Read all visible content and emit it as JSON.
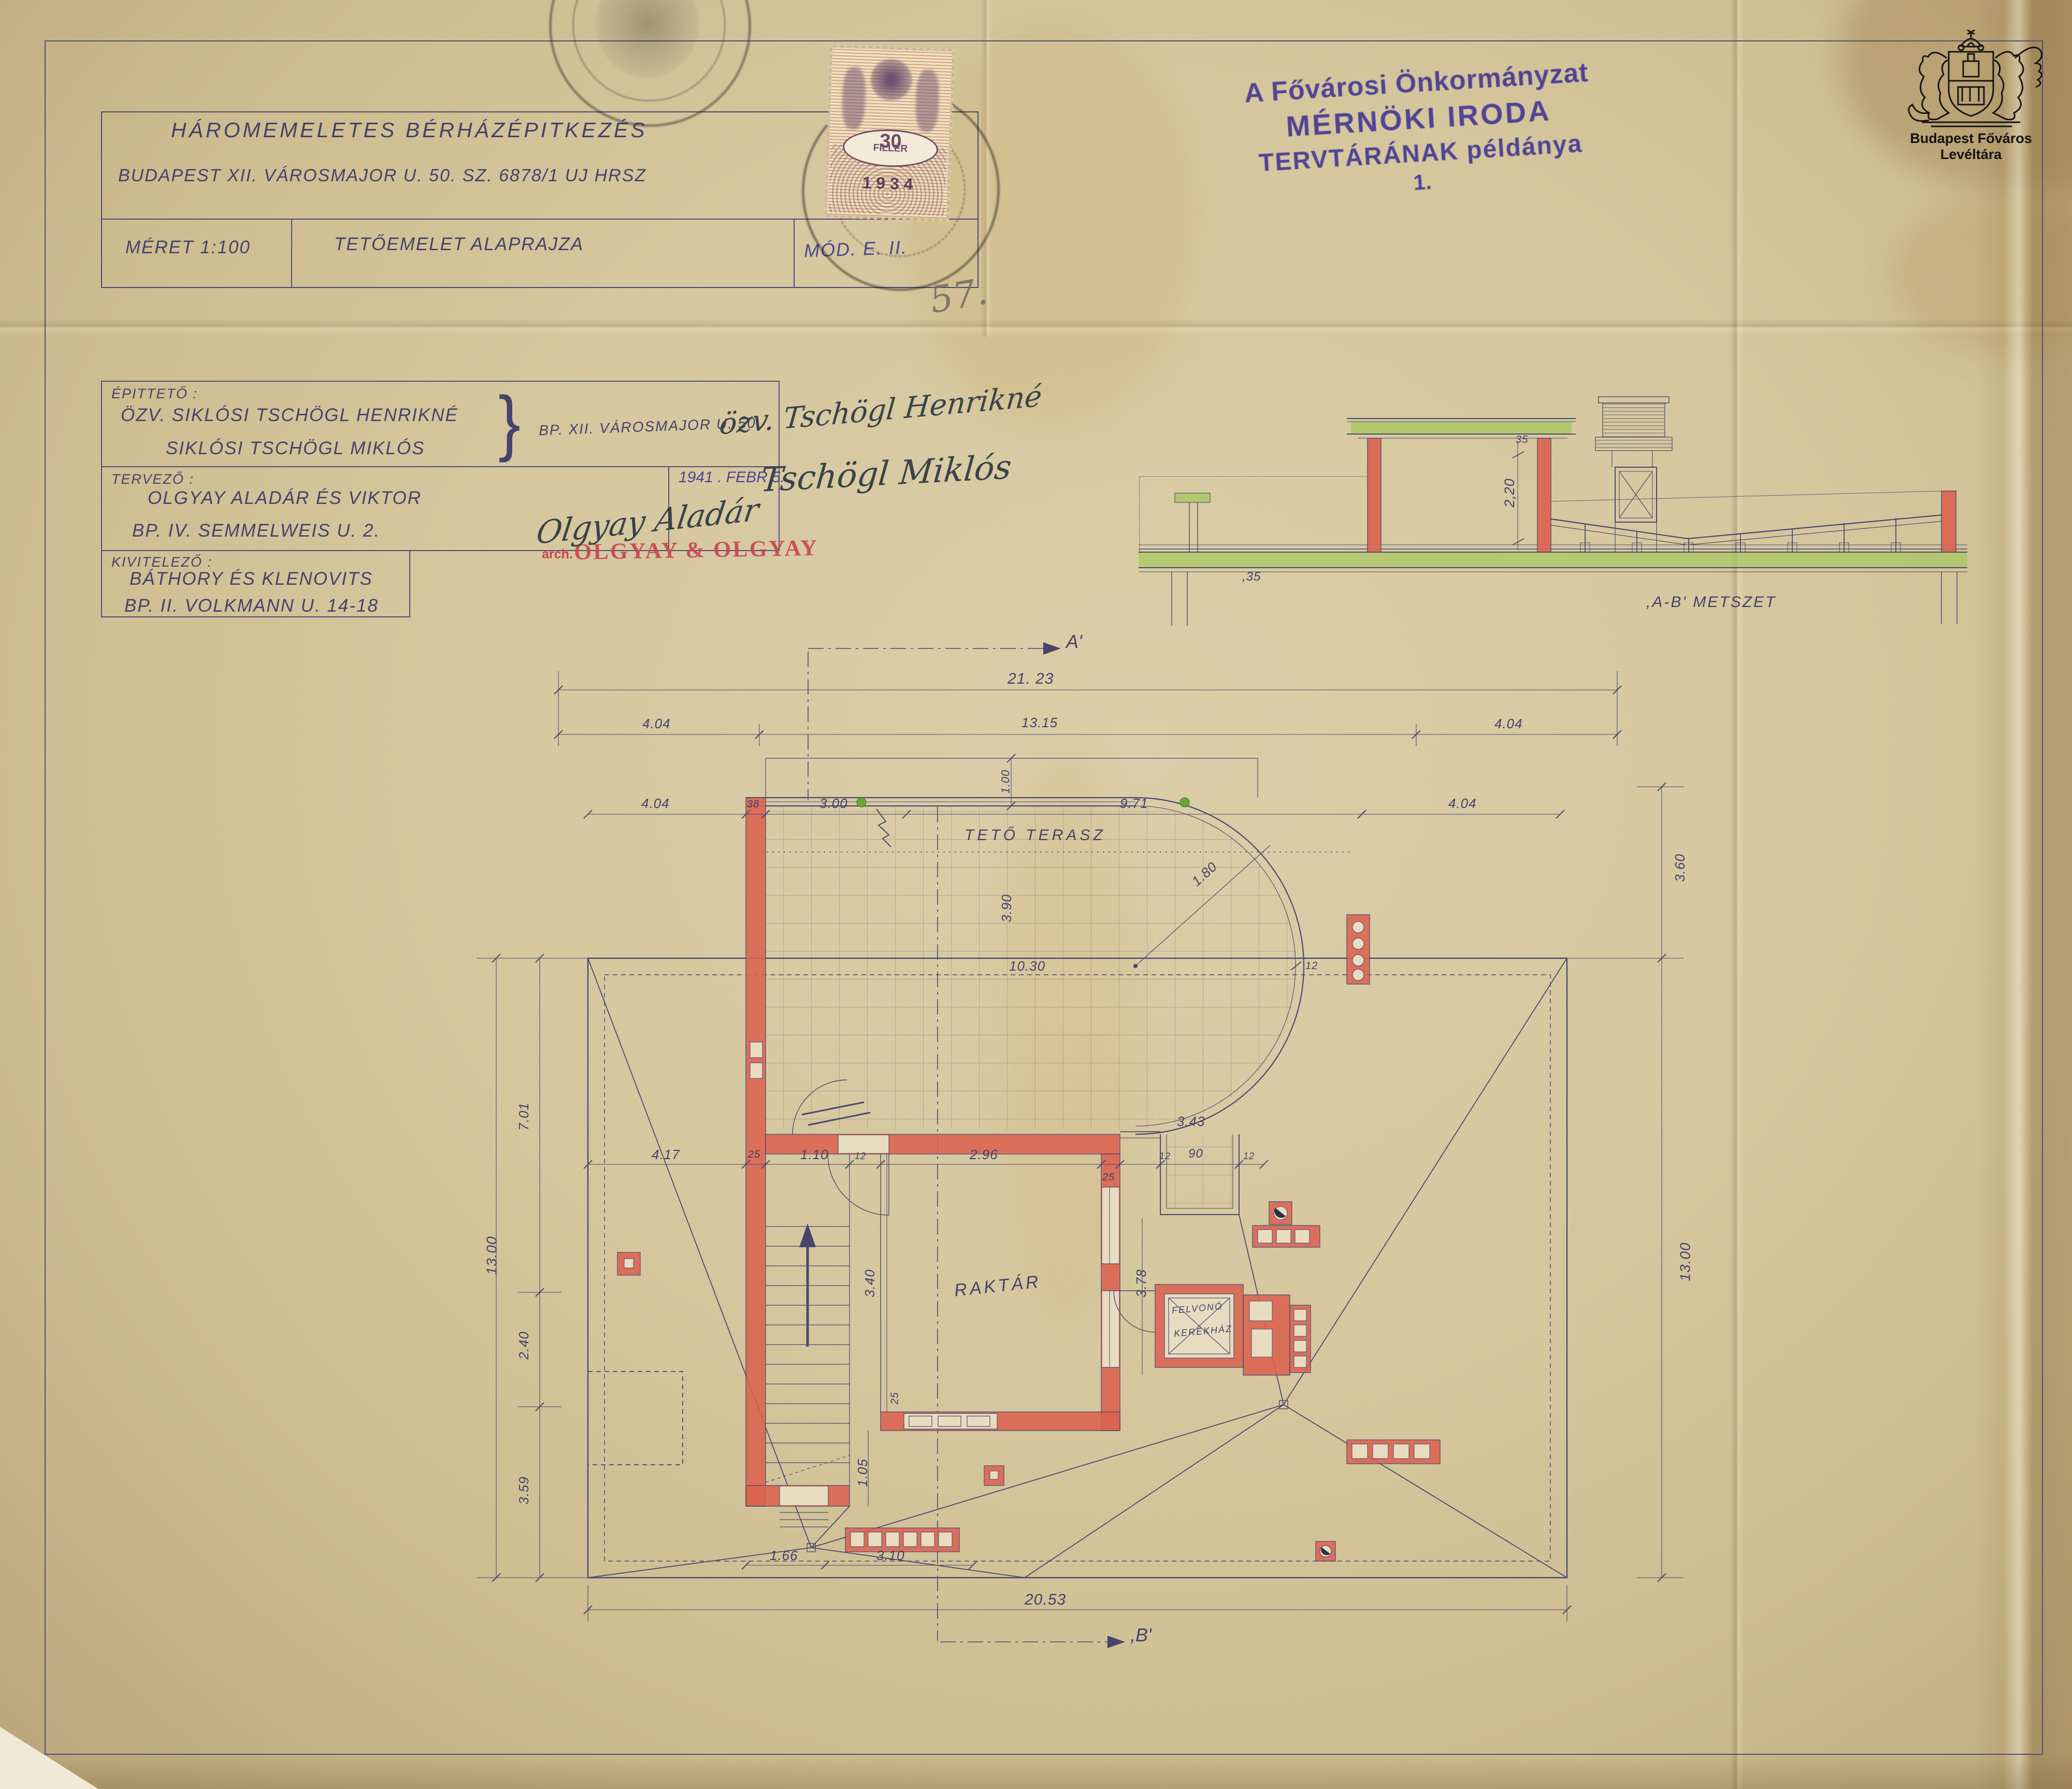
{
  "document": {
    "archive_logo": {
      "caption": "Budapest Főváros Levéltára"
    },
    "archive_stamp": {
      "line1": "A Fővárosi Önkormányzat",
      "line2": "MÉRNÖKI IRODA",
      "line3": "TERVTÁRÁNAK példánya",
      "line4": "1."
    },
    "revenue_stamp": {
      "value": "30",
      "unit": "FILLÉR",
      "year": "1 9 3 4"
    },
    "page_number_pencil": "57.",
    "title_block": {
      "title": "HÁROMEMELETES   BÉRHÁZÉPITKEZÉS",
      "address": "BUDAPEST  XII.  VÁROSMAJOR  U.  50. SZ.  6878/1  UJ  HRSZ",
      "scale": "MÉRET  1:100",
      "drawing": "TETŐEMELET   ALAPRAJZA",
      "mod": "MÓD.   E.  II."
    },
    "parties": {
      "client_label": "ÉPITTETŐ :",
      "client_name1": "ÖZV.  SIKLÓSI   TSCHÖGL   HENRIKNÉ",
      "client_name2": "SIKLÓSI   TSCHÖGL   MIKLÓS",
      "client_address": "BP. XII.  VÁROSMAJOR  U.  50",
      "client_signature1": "özv. Tschögl Henrikné",
      "client_signature2": "Tschögl Miklós",
      "designer_label": "TERVEZŐ :",
      "designer_name": "OLGYAY   ALADÁR   ÉS   VIKTOR",
      "designer_address": "BP.  IV.   SEMMELWEIS   U.  2.",
      "designer_stamp_prefix": "arch.",
      "designer_stamp": "OLGYAY & OLGYAY",
      "designer_signature": "Olgyay Aladár",
      "date": "1941 .  FEBR  5.",
      "contractor_label": "KIVITELEZŐ :",
      "contractor_name": "BÁTHORY   ÉS   KLENOVITS",
      "contractor_address": "BP.  II.   VOLKMANN   U.  14-18"
    }
  },
  "section": {
    "label": ",A-B'  METSZET",
    "dim_35top": "35",
    "dim_220": "2,20",
    "dim_35bottom": ",35"
  },
  "plan": {
    "labels": {
      "terrace": "TETŐ TERASZ",
      "storage": "RAKTÁR",
      "lift1": "FELVONÓ",
      "lift2": "KERÉKHÁZ",
      "sec_a": "A'",
      "sec_b": ",B'"
    },
    "dims": {
      "t2123": "21. 23",
      "b404a": "4.04",
      "b1315": "13.15",
      "b404b": "4.04",
      "c404": "4.04",
      "c38": "38",
      "c300": "3.00",
      "c971": "9.71",
      "c404r": "4.04",
      "tz100": "1.00",
      "tz390": "3.90",
      "tz1030": "10.30",
      "tz180": "1.80",
      "tz12": "12",
      "l701": "7.01",
      "l1300": "13.00",
      "l240": "2.40",
      "l359": "3.59",
      "r360": "3.60",
      "r1300": "13.00",
      "m417": "4.17",
      "m25a": "25",
      "m110": "1.10",
      "m12a": "12",
      "m296": "2.96",
      "m25b": "25",
      "m343": "3.43",
      "m12b": "12",
      "m90": "90",
      "m12c": "12",
      "v378": "3.78",
      "v340": "3.40",
      "v105": "1.05",
      "v25": "25",
      "s166": "1.66",
      "s310": "3.10",
      "total": "20.53"
    }
  },
  "colors": {
    "ink": "#46446b",
    "accent_red": "#dc6350",
    "accent_green": "#a9c861",
    "stamp_purple": "#4a3d96",
    "stamp_red": "#c9454f"
  }
}
